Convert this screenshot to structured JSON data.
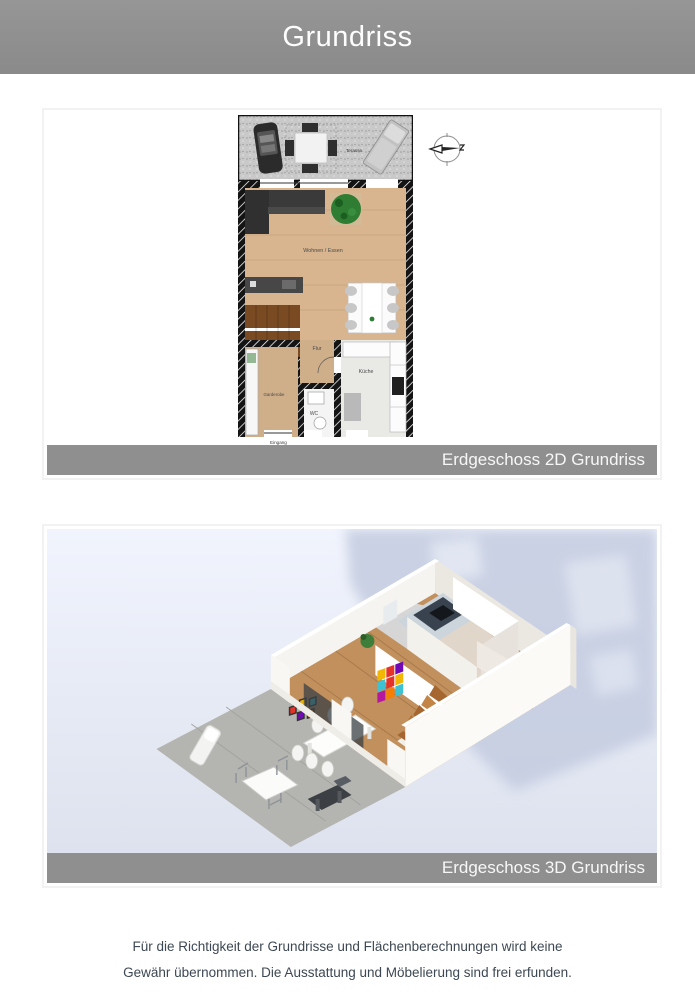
{
  "header": {
    "title": "Grundriss"
  },
  "plan2d": {
    "caption": "Erdgeschoss 2D Grundriss",
    "labels": {
      "terrace": "Terasse",
      "living": "Wohnen / Essen",
      "hall": "Flur",
      "kitchen": "Küche",
      "wardrobe": "Garderobe",
      "wc": "WC",
      "entrance": "Eingang"
    }
  },
  "plan3d": {
    "caption": "Erdgeschoss 3D Grundriss"
  },
  "footer": {
    "line1": "Für die Richtigkeit der Grundrisse und Flächenberechnungen wird keine",
    "line2": "Gewähr übernommen. Die Ausstattung und Möbelierung sind frei erfunden."
  },
  "colors": {
    "header_bg": "#8f8f8f",
    "caption_bg": "#8f8f8f",
    "caption_text": "#f7f7f7",
    "footer_text": "#3d4854",
    "card_border": "#f2f2f2",
    "plan_wall": "#111111",
    "plan_wood_floor": "#d8b58f",
    "plan_terrace": "#c9c9c9",
    "render_bg_top": "#f0f3fc",
    "render_bg_bottom": "#dde2ee",
    "render_shadow": "#c3cbdf"
  }
}
